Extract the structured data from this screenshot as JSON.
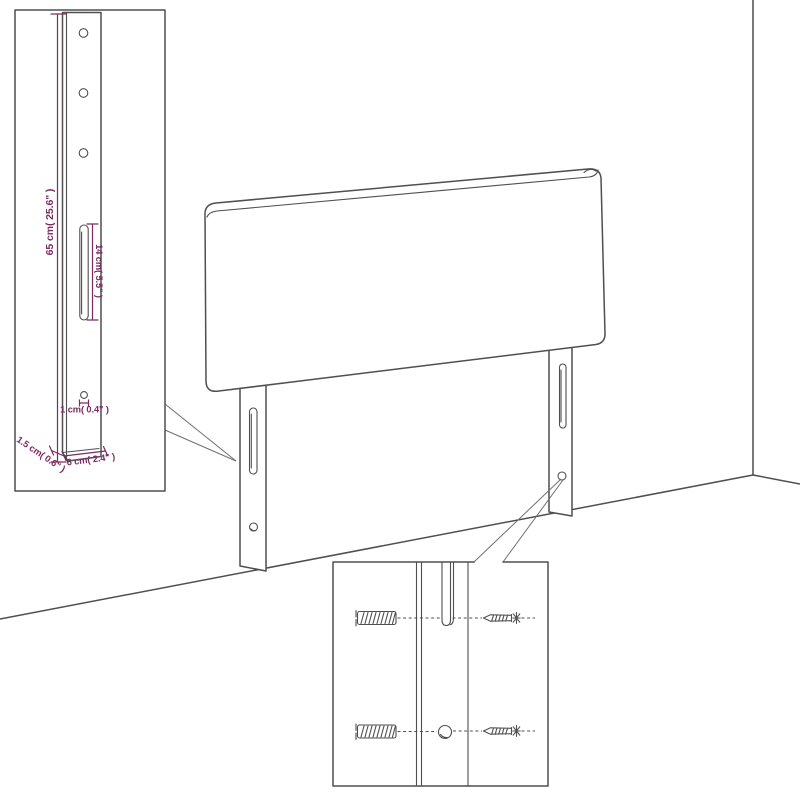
{
  "diagram": {
    "subject": "headboard-with-legs-wall-mounting",
    "colors": {
      "line": "#4f4f4f",
      "dimension": "#7b2a62",
      "background": "#ffffff"
    },
    "inset": {
      "height_label": "65 cm( 25.6\" )",
      "slot_label": "14 cm( 5.5\" )",
      "hole_label": "1 cm( 0.4\" )",
      "side_label": "1.5 cm( 0.6\" )",
      "width_label": "6 cm( 2.4\" )"
    }
  }
}
